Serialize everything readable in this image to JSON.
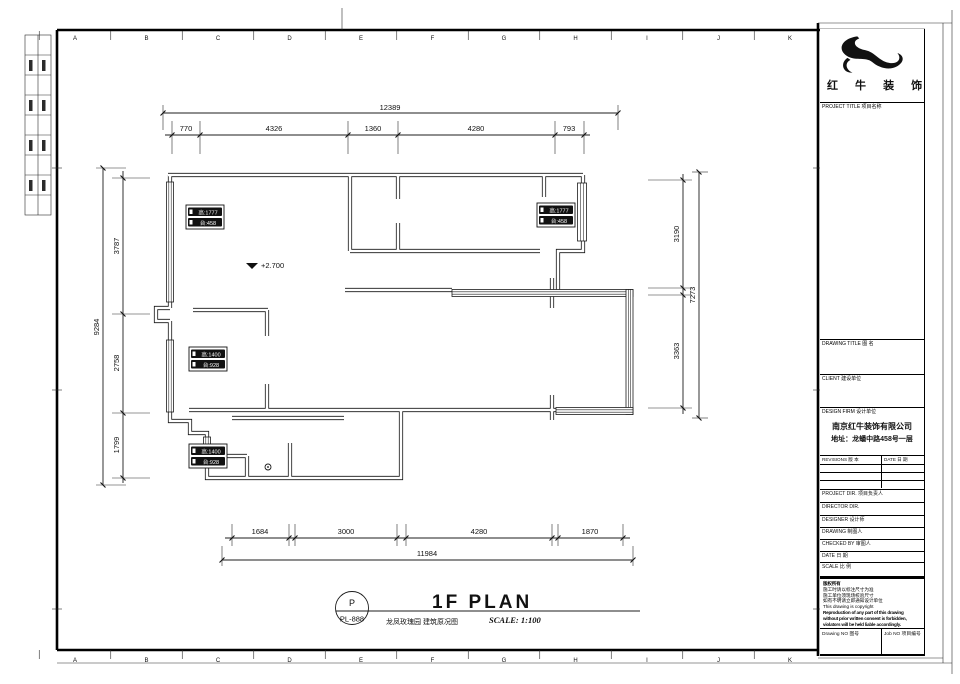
{
  "grid": {
    "letters": [
      "A",
      "B",
      "C",
      "D",
      "E",
      "F",
      "G",
      "H",
      "I",
      "J",
      "K"
    ]
  },
  "dims": {
    "top": {
      "total": "12389",
      "chain": [
        "770",
        "4326",
        "1360",
        "4280",
        "793"
      ]
    },
    "bottom": {
      "total": "11984",
      "chain": [
        "1684",
        "3000",
        "4280",
        "1870"
      ]
    },
    "left": {
      "total": "9284",
      "chain": [
        "3787",
        "2758",
        "1799"
      ]
    },
    "right": {
      "total": "7273",
      "chain": [
        "3190",
        "3363"
      ]
    }
  },
  "plan": {
    "level_mark": "+2.700",
    "window_labels": [
      {
        "line1": "高:1777",
        "line2": "台:458"
      },
      {
        "line1": "高:1777",
        "line2": "台:458"
      },
      {
        "line1": "高:1400",
        "line2": "台:928"
      },
      {
        "line1": "高:1400",
        "line2": "台:928"
      }
    ]
  },
  "footer": {
    "stamp_top": "P",
    "stamp_bottom": "PL-888",
    "plan_title": "1F PLAN",
    "plan_subtitle": "龙凤玫瑰园 建筑原况图",
    "scale_text": "SCALE: 1:100"
  },
  "title_block": {
    "company_name": "红 牛 装 饰",
    "project_title_label": "PROJECT TITLE  项目名称",
    "drawing_title_label": "DRAWING TITLE  图 名",
    "client_label": "CLIENT  建设单位",
    "design_firm_label": "DESIGN FIRM  设计单位",
    "design_firm_name": "南京红牛装饰有限公司",
    "design_firm_address": "地址：龙蟠中路458号一层",
    "revisions_label": "REVISIONS  版 本",
    "date_col_label": "DATE 日 期",
    "project_dir_label": "PROJECT DIR.   项目负责人",
    "director_label": "DIRECTOR DIR.",
    "designer_label": "DESIGNER    设计师",
    "drawing_label": "DRAWING    制图人",
    "checked_label": "CHECKED BY   审图人",
    "date_label": "DATE      日 期",
    "scale_label": "SCALE     比 例",
    "notes": [
      "版权所有",
      "施工时请以标注尺寸为准",
      "施工单位须现场校验尺寸",
      "如有不明请立即通知设计单位",
      "This drawing is copyright",
      "Reproduction of any part of this drawing",
      "without prior written consent is forbidden,",
      "violators will be held liable accordingly."
    ],
    "drawing_no_label": "Drawing NO  图号",
    "job_no_label": "Job NO  项目编号"
  }
}
